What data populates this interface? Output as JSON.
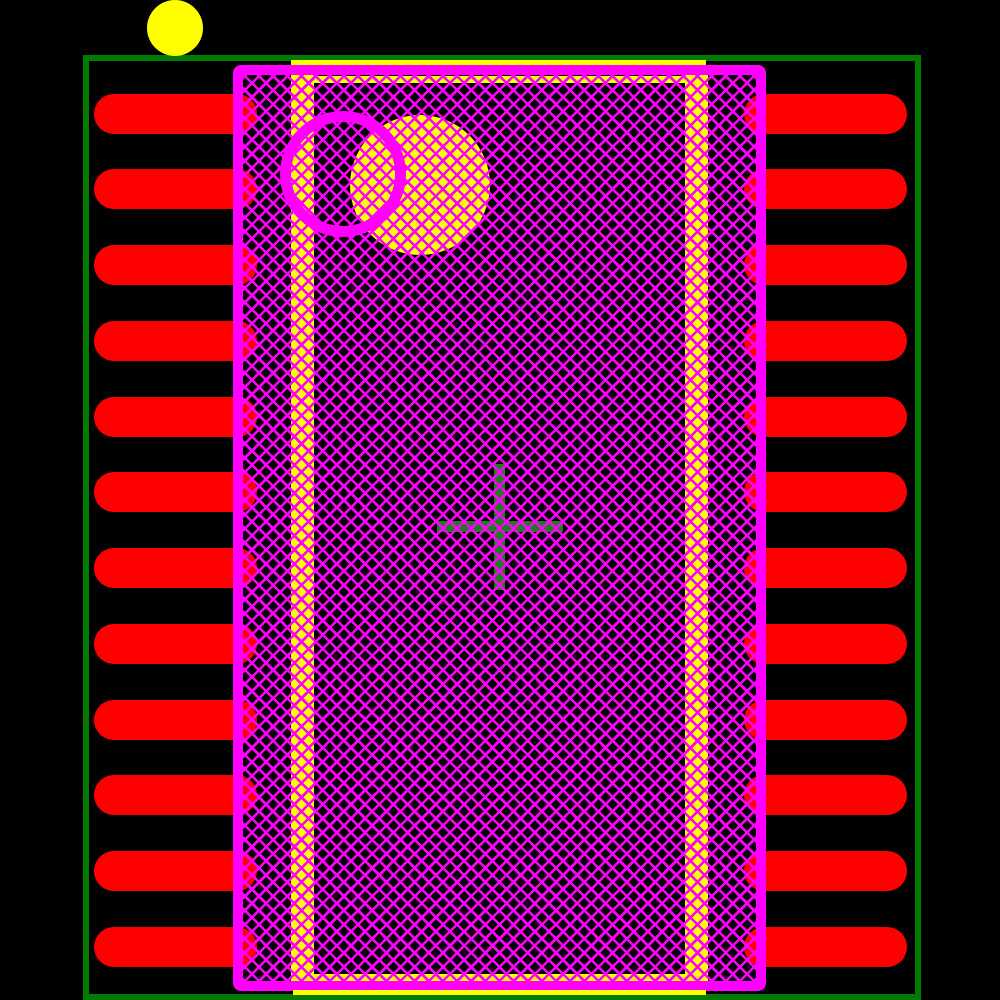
{
  "colors": {
    "background": "#000000",
    "courtyard": "#007A00",
    "pad": "#FF0000",
    "silkscreen": "#FF00FF",
    "assembly": "#FFFF00",
    "pin1_indicator": "#FFFF00",
    "origin_cross": "#1E7E1E",
    "body_fill": "#000000"
  },
  "pads": {
    "count_per_side": 12,
    "left_x": 94,
    "right_x": 744,
    "width": 163,
    "height": 40,
    "pitch": 75.76,
    "first_top": 93.5
  },
  "geometry": {
    "canvas": {
      "width": 1000,
      "height": 1000
    },
    "courtyard_outline": {
      "x": 83,
      "y": 55,
      "width": 838,
      "height": 945,
      "stroke": 6
    },
    "pin1_indicator_dot": {
      "cx": 175,
      "cy": 28,
      "r": 28
    },
    "silkscreen_body_outline": {
      "x": 233,
      "y": 65,
      "width": 533,
      "height": 926,
      "stroke": 10
    },
    "silkscreen_pin1_ring": {
      "cx": 343,
      "cy": 174,
      "outer_r": 63,
      "stroke": 11
    },
    "assembly_pin1_circle": {
      "cx": 420,
      "cy": 185,
      "r": 70
    },
    "assembly_strip_left": {
      "x": 291,
      "y": 75,
      "width": 23,
      "height": 906
    },
    "assembly_strip_right": {
      "x": 685,
      "y": 75,
      "width": 23,
      "height": 906
    },
    "assembly_line_top_solid": {
      "x": 291,
      "y": 60,
      "width": 415,
      "height": 5
    },
    "assembly_line_bottom_solid": {
      "x": 293,
      "y": 990,
      "width": 413,
      "height": 5
    },
    "assembly_line_top_hatched": {
      "x": 314,
      "y": 76,
      "width": 372,
      "height": 7
    },
    "assembly_line_bottom_hatched": {
      "x": 314,
      "y": 974,
      "width": 372,
      "height": 7
    },
    "origin_cross": {
      "cx": 500,
      "cy": 527,
      "arm_length": 126,
      "arm_thickness": 11
    },
    "body_hatch": {
      "angle_deg": 45,
      "period": 10,
      "line_width": 2.6
    }
  }
}
